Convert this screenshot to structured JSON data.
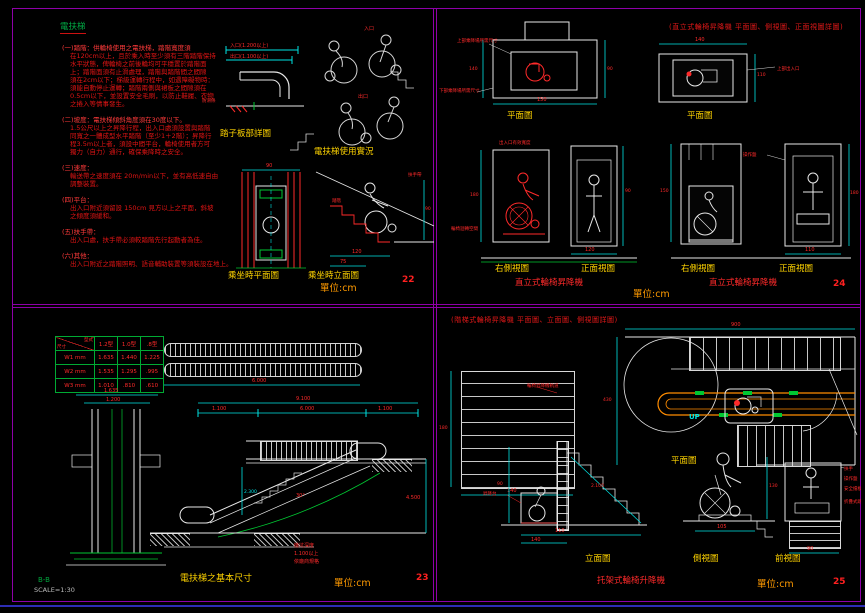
{
  "tl": {
    "title": "電扶梯",
    "notes": [
      {
        "head": "(一)踏階：供輪椅使用之電扶梯，踏階寬度須",
        "lines": [
          "在120cm以上，且於乘入時至少須有三階踏階保持",
          "水平狀態，俾輪椅之前後輪均可平穩置於踏階面",
          "上；踏階面須有止滑處理，踏階與踏階間之間隙",
          "須在2cm以下；梯級運轉行程中，如遇障礙物時：",
          "須能自動停止運轉；踏階兩側與裙板之間隙須在",
          "0.5cm以下，並設置安全毛刷，以防止鞋履、衣物",
          "之捲入等情事發生。"
        ]
      },
      {
        "head": "(二)坡度：電扶梯傾斜角度須在30度以下。",
        "lines": [
          "1.5公尺以上之昇降行程，出入口處須設置與踏階",
          "同寬之一體成型水平踏階（至少1＋2階）；昇降行",
          "程3.5m以上者，須設中間平台，輪椅使用者方可",
          "獨力（自力）通行，確保乘降時之安全。"
        ]
      },
      {
        "head": "(三)速度：",
        "lines": [
          "輸送帶之速度須在 20m/min以下，並有高低速自由",
          "調整裝置。"
        ]
      },
      {
        "head": "(四)平台：",
        "lines": [
          "出入口附近須留設 150cm 見方以上之平面，斜坡",
          "之傾度須緩和。"
        ]
      },
      {
        "head": "(五)扶手帶：",
        "lines": [
          "出入口處，扶手帶必須較踏階先行起動者為佳。"
        ]
      },
      {
        "head": "(六)其他：",
        "lines": [
          "出入口附近之踏階照明、語音輔助裝置等須裝設在地上。"
        ]
      }
    ],
    "labels": {
      "step_detail": "踏子板部詳圖",
      "usage": "電扶梯使用實況",
      "plan": "乘坐時平面圖",
      "elev": "乘坐時立面圖",
      "unit": "單位:cm",
      "page": "22"
    },
    "dims": {
      "entry": "入口(1.200以上)",
      "exit": "出口(1.100以上)",
      "entry_s": "入口",
      "exit_s": "出口",
      "antislip": "防滑條",
      "plan_w": "90",
      "elev_b": "120",
      "elev_a": "75",
      "elev_h": "90",
      "handrail": "扶手帶",
      "step": "踏階"
    }
  },
  "tr": {
    "title": "(直立式輪椅昇降機 平面圖、側視圖、正面視圖詳圖)",
    "labels": {
      "plan_a": "平面圖",
      "plan_b": "平面圖",
      "side_a": "右側視圖",
      "front_a": "正面視圖",
      "side_b": "右側視圖",
      "front_b": "正面視圖",
      "cap_a": "直立式輪椅昇降機",
      "cap_b": "直立式輪椅昇降機",
      "unit": "單位:cm",
      "page": "24"
    },
    "leaders": {
      "upper": "上部乘降場所需尺寸",
      "lower": "下部乘降場所需尺寸",
      "door": "出入口有效寬度",
      "turn": "輪椅迴轉空間",
      "upper_exit": "上部出入口",
      "panel": "操作盤"
    },
    "dims": {
      "p1_w": "150",
      "p1_l": "140",
      "p1_r": "90",
      "p2_w": "140",
      "p2_r": "110",
      "sa_h": "180",
      "fa_w": "120",
      "fa_h": "90",
      "sb_h": "150",
      "fb_h": "180",
      "fb_w": "110"
    }
  },
  "bl": {
    "table": {
      "corner_top": "型式",
      "corner_bottom": "尺寸",
      "cols": [
        "1.2型",
        "1.0型",
        ".8型"
      ],
      "rows": [
        {
          "name": "W1 mm",
          "v": [
            "1.635",
            "1.440",
            "1.225"
          ]
        },
        {
          "name": "W2 mm",
          "v": [
            "1.535",
            "1.295",
            ".995"
          ]
        },
        {
          "name": "W3 mm",
          "v": [
            "1.010",
            ".810",
            ".610"
          ]
        }
      ]
    },
    "labels": {
      "caption": "電扶梯之基本尺寸",
      "unit": "單位:cm",
      "page": "23",
      "section": "B-B",
      "scale": "SCALE=1:30"
    },
    "dims": {
      "cs_w": "1.635",
      "cs_i": "1.200",
      "plan_l": "6.000",
      "total": "9.100",
      "left": "1.100",
      "mid": "6.000",
      "right": "1.100",
      "height": "4.500",
      "rise": "2.300",
      "angle": "30°"
    },
    "note": [
      "機坑深度",
      "1.100以上",
      "依廠商規格"
    ]
  },
  "br": {
    "title": "(階梯式輪椅昇降機 平面圖、立面圖、側視圖詳圖)",
    "labels": {
      "plan": "平面圖",
      "elev": "立面圖",
      "side": "側視圖",
      "front": "前視圖",
      "caption": "托架式輪椅升降機",
      "unit": "單位:cm",
      "page": "25"
    },
    "leaders": {
      "rail": "輪椅昇降機軌道",
      "platform": "昇降台",
      "armrest": "扶手",
      "panel": "操作盤",
      "guard": "安全擋板",
      "flap": "折疊式踏板"
    },
    "up": "UP",
    "dims": {
      "plan_w": "900",
      "plan_l": "430",
      "stair_w": "140",
      "stair_h": "180",
      "el_a": "110",
      "el_b": "140",
      "el_h": "90",
      "el_s": "2.100",
      "sv_h": "130",
      "sv_w": "105",
      "fv_w": "90"
    }
  }
}
